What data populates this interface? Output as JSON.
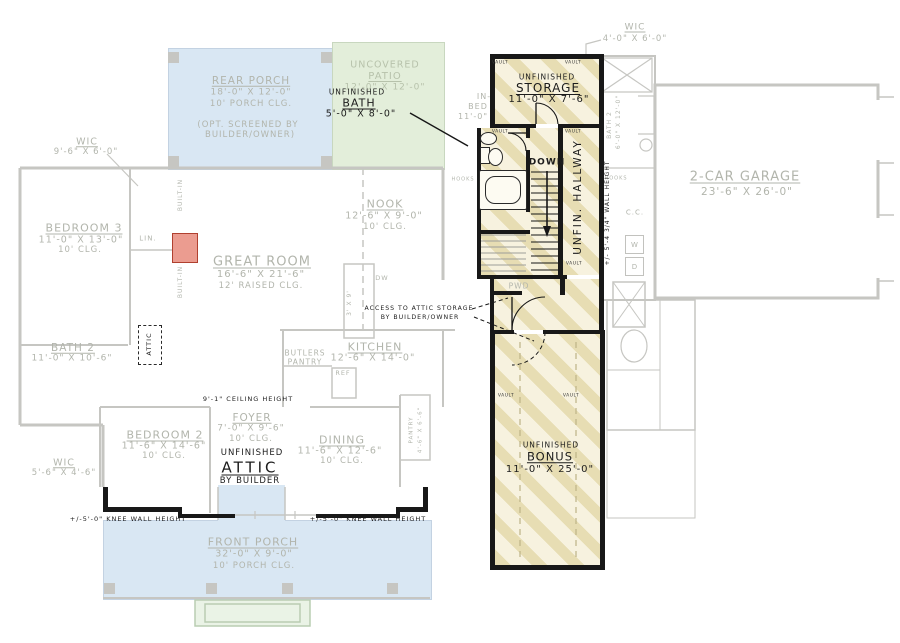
{
  "colors": {
    "porch_blue": "#d9e7f3",
    "patio_green": "#e3eeda",
    "stoop_green": "#eaf3e6",
    "stripe_tan": "#e7ddb3",
    "stripe_bg": "#f7f2df",
    "faded_line": "#c6c6c2",
    "faded_text": "#b2b5ac",
    "wall_dark": "#181818",
    "fireplace_red": "#eb9c90"
  },
  "labels": {
    "rear_porch": {
      "name": "REAR PORCH",
      "dims": "18'-0\" X 12'-0\"",
      "clg": "10' PORCH CLG.",
      "opt1": "(OPT. SCREENED BY",
      "opt2": "BUILDER/OWNER)"
    },
    "patio": {
      "l1": "UNCOVERED",
      "l2": "PATIO",
      "dims": "12'-0\" X 12'-0\""
    },
    "wic_tl": {
      "name": "WIC",
      "dims": "9'-6\" X 6'-0\""
    },
    "bedroom3": {
      "name": "BEDROOM 3",
      "dims": "11'-0\" X 13'-0\"",
      "clg": "10' CLG."
    },
    "bath2_left": {
      "name": "BATH 2",
      "dims": "11'-0\" X 10'-6\""
    },
    "wic_bl": {
      "name": "WIC",
      "dims": "5'-6\" X 4'-6\""
    },
    "nook": {
      "name": "NOOK",
      "dims": "12'-6\" X 9'-0\"",
      "clg": "10' CLG."
    },
    "great_room": {
      "name": "GREAT ROOM",
      "dims": "16'-6\" X 21'-6\"",
      "clg": "12' RAISED CLG."
    },
    "kitchen": {
      "name": "KITCHEN",
      "dims": "12'-6\" X 14'-0\""
    },
    "butlers": {
      "l1": "BUTLERS",
      "l2": "PANTRY"
    },
    "foyer": {
      "name": "FOYER",
      "dims": "7'-0\" X 9'-6\"",
      "clg": "10' CLG."
    },
    "dining": {
      "name": "DINING",
      "dims": "11'-6\" X 12'-6\"",
      "clg": "10' CLG."
    },
    "pantry": {
      "name": "PANTRY",
      "dims": "4'-6\" X 6'-6\""
    },
    "bedroom2": {
      "name": "BEDROOM 2",
      "dims": "11'-6\" X 14'-6\"",
      "clg": "10' CLG."
    },
    "front_porch": {
      "name": "FRONT PORCH",
      "dims": "32'-0\" X 9'-0\"",
      "clg": "10' PORCH CLG."
    },
    "garage": {
      "name": "2-CAR GARAGE",
      "dims": "23'-6\" X 26'-0\""
    },
    "bath2_right": {
      "name": "BATH 2",
      "dims": "6'-0\" X 12'-0\""
    },
    "wic_tr": {
      "name": "WIC",
      "dims": "4'-0\" X 6'-0\""
    },
    "inbed": {
      "l1": "IN-",
      "l2": "BED",
      "l3": "11'-0\""
    },
    "island_dims": "3' X 9'",
    "lin": "LIN.",
    "ref": "REF",
    "dw": "DW",
    "pwd": "PWD",
    "cc": "C.C.",
    "w": "W",
    "d": "D",
    "hooks": "HOOKS",
    "built_in": "BUILT-IN"
  },
  "second_floor": {
    "bath": {
      "l1": "UNFINISHED",
      "l2": "BATH",
      "dims": "5'-0\" X 8'-0\""
    },
    "storage": {
      "l1": "UNFINISHED",
      "l2": "STORAGE",
      "dims": "11'-0\" X 7'-6\""
    },
    "bonus": {
      "l1": "UNFINISHED",
      "l2": "BONUS",
      "dims": "11'-0\" X 25'-0\""
    },
    "attic": {
      "l1": "UNFINISHED",
      "l2": "ATTIC",
      "l3": "BY BUILDER"
    },
    "hallway": "UNFIN. HALLWAY",
    "down": "DOWN",
    "attic_access": "ATTIC",
    "access_note": {
      "l1": "ACCESS TO ATTIC STORAGE",
      "l2": "BY BUILDER/OWNER"
    },
    "ceiling_note": "9'-1\" CEILING HEIGHT",
    "wall_height_note": "+/- 5'-4 3/4\" WALL HEIGHT",
    "knee_wall_note": "+/-5'-0\" KNEE WALL HEIGHT",
    "vault": "VAULT"
  }
}
